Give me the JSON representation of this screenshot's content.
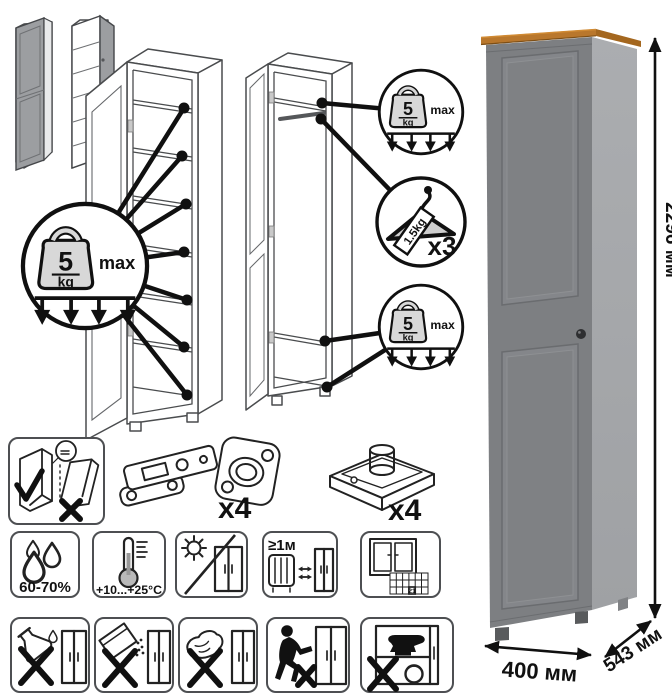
{
  "sheet": {
    "shelf_load": {
      "value": "5",
      "unit": "kg",
      "qualifier": "max"
    },
    "hanger_load": {
      "tag": "1.5kg",
      "count": "x3"
    },
    "hardware": {
      "hinge_count": "x4",
      "foot_count": "x4"
    },
    "dimensions": {
      "height": "2296 мм",
      "width": "400 мм",
      "depth": "543 мм"
    },
    "care": {
      "humidity": "60-70%",
      "temperature": "+10...+25°C",
      "min_distance": "≥1м",
      "ventilation_day": "21"
    },
    "colors": {
      "body_front": "#7d7f82",
      "body_side": "#a6a8ab",
      "wood_top": "#b9772c",
      "line": "#1a1a1a"
    }
  }
}
